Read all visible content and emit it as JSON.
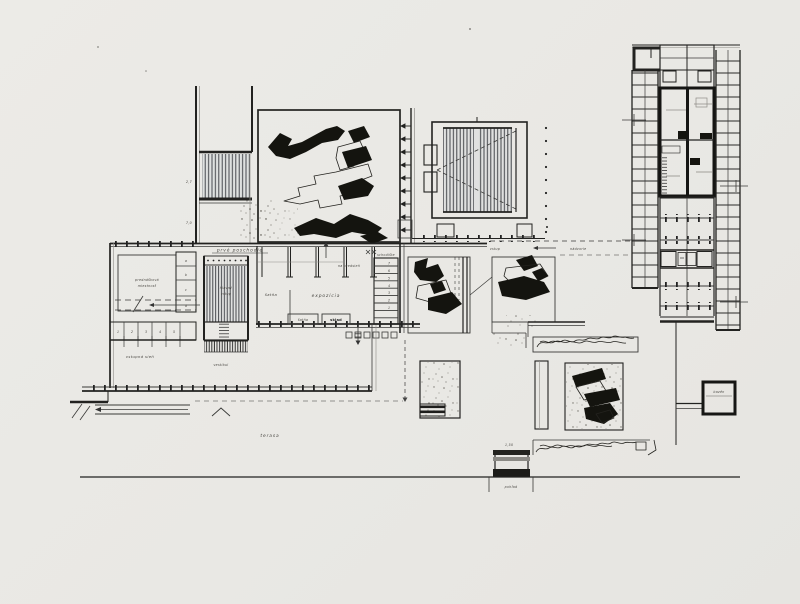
{
  "document": {
    "kind": "scanned architectural floor plan sketch",
    "floor_caption": "prvé poschodie"
  },
  "colors": {
    "paper": "#e9e8e4",
    "ink": "#222220",
    "pencil": "#8f8d88",
    "tint_blue": "#a9b6c0"
  },
  "labels": {
    "floor_caption": "prvé poschodie",
    "left_room_line1": "prednášková",
    "left_room_line2": "miestnosť",
    "left_wing": "vstupná sieň",
    "vestibule": "vestibul",
    "ramp_line1": "hlavný",
    "ramp_line2": "vstup",
    "cloak_small": "šatňa",
    "exhibition": "expozícia",
    "to_mezz": "na predsieň",
    "cloak_box": "šatňa",
    "store_box": "sklad",
    "stair": "schodište",
    "entry_note": "vstup",
    "court_note": "nádvorie",
    "terrace": "terasa",
    "pool": "bazén",
    "bench_dim": "1,50",
    "view_note": "pohľad",
    "level_a": "2,7",
    "level_b": "7,0",
    "cell_col": [
      "a",
      "b",
      "c",
      "d"
    ],
    "cell_row": [
      "1",
      "2",
      "3",
      "4",
      "5"
    ],
    "treads": [
      "7",
      "6",
      "5",
      "4",
      "3",
      "2",
      "1"
    ]
  }
}
